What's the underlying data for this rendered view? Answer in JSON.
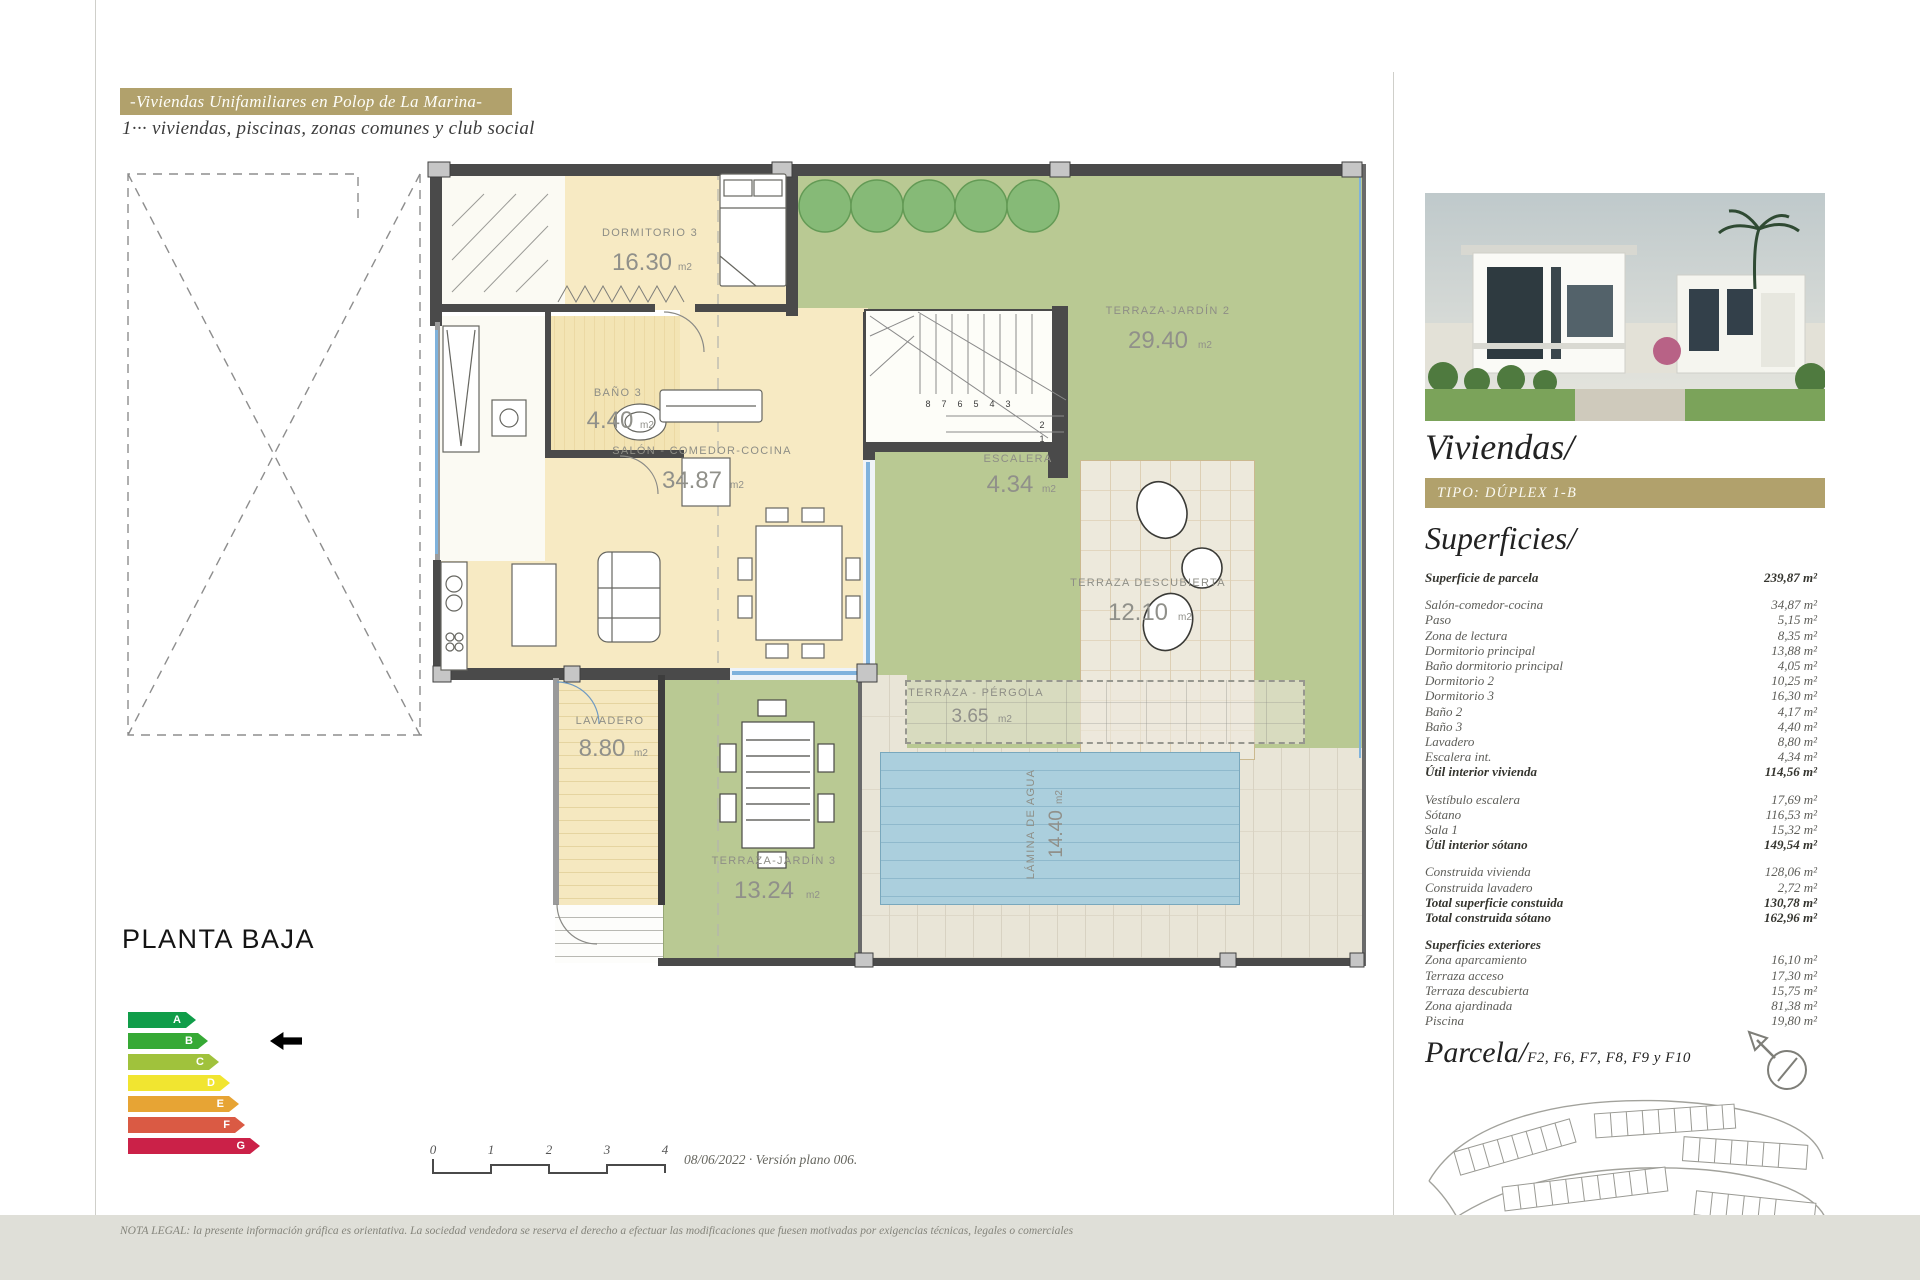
{
  "header": {
    "banner_title": "-Viviendas Unifamiliares en Polop de La Marina-",
    "subtitle": "1··· viviendas, piscinas, zonas comunes y club social",
    "accent_color": "#b1a16c"
  },
  "plan": {
    "title": "PLANTA BAJA",
    "unit": "m2",
    "rooms": {
      "dormitorio3": {
        "name": "DORMITORIO 3",
        "area": "16.30"
      },
      "bano3": {
        "name": "BAÑO 3",
        "area": "4.40"
      },
      "salon": {
        "name": "SALÓN - COMEDOR-COCINA",
        "area": "34.87"
      },
      "escalera": {
        "name": "ESCALERA",
        "area": "4.34"
      },
      "terraza_jardin2": {
        "name": "TERRAZA-JARDÍN 2",
        "area": "29.40"
      },
      "terraza_descubierta": {
        "name": "TERRAZA DESCUBIERTA",
        "area": "12.10"
      },
      "terraza_pergola": {
        "name": "TERRAZA - PÉRGOLA",
        "area": "3.65"
      },
      "lavadero": {
        "name": "LAVADERO",
        "area": "8.80"
      },
      "terraza_jardin3": {
        "name": "TERRAZA-JARDÍN 3",
        "area": "13.24"
      },
      "lamina_agua": {
        "name": "LÁMINA DE AGUA",
        "area": "14.40"
      }
    },
    "stairs": [
      "8",
      "7",
      "6",
      "5",
      "4",
      "3",
      "2",
      "1"
    ]
  },
  "energy_chart": {
    "type": "energy-rating-scale",
    "items": [
      {
        "letter": "A",
        "color": "#109d49"
      },
      {
        "letter": "B",
        "color": "#36a935"
      },
      {
        "letter": "C",
        "color": "#a0c23c"
      },
      {
        "letter": "D",
        "color": "#f1e530"
      },
      {
        "letter": "E",
        "color": "#e7a434"
      },
      {
        "letter": "F",
        "color": "#da5a44"
      },
      {
        "letter": "G",
        "color": "#cb2148"
      }
    ],
    "marker": "B"
  },
  "scale_bar": {
    "ticks": [
      "0",
      "1",
      "2",
      "3",
      "4"
    ],
    "note": "08/06/2022 · Versión plano 006."
  },
  "sidebar": {
    "title": "Viviendas/",
    "tipo_banner": "TIPO: DÚPLEX 1-B",
    "superficies_title": "Superficies/",
    "parcela_title": "Parcela/",
    "parcela_refs": "F2, F6, F7, F8, F9 y F10",
    "accent_color": "#b1a16c",
    "plot_highlight_color": "#d4156b",
    "table": {
      "sections": [
        {
          "rows": [
            {
              "label": "Superficie de parcela",
              "value": "239,87 m²",
              "bold": true
            }
          ]
        },
        {
          "rows": [
            {
              "label": "Salón-comedor-cocina",
              "value": "34,87 m²"
            },
            {
              "label": "Paso",
              "value": "5,15 m²"
            },
            {
              "label": "Zona de lectura",
              "value": "8,35 m²"
            },
            {
              "label": "Dormitorio principal",
              "value": "13,88 m²"
            },
            {
              "label": "Baño dormitorio principal",
              "value": "4,05 m²"
            },
            {
              "label": "Dormitorio 2",
              "value": "10,25 m²"
            },
            {
              "label": "Dormitorio 3",
              "value": "16,30 m²"
            },
            {
              "label": "Baño 2",
              "value": "4,17 m²"
            },
            {
              "label": "Baño 3",
              "value": "4,40 m²"
            },
            {
              "label": "Lavadero",
              "value": "8,80 m²"
            },
            {
              "label": "Escalera int.",
              "value": "4,34 m²"
            },
            {
              "label": "Útil interior vivienda",
              "value": "114,56 m²",
              "bold": true
            }
          ]
        },
        {
          "rows": [
            {
              "label": "Vestíbulo escalera",
              "value": "17,69 m²"
            },
            {
              "label": "Sótano",
              "value": "116,53 m²"
            },
            {
              "label": "Sala 1",
              "value": "15,32 m²"
            },
            {
              "label": "Útil interior sótano",
              "value": "149,54 m²",
              "bold": true
            }
          ]
        },
        {
          "rows": [
            {
              "label": "Construida vivienda",
              "value": "128,06 m²"
            },
            {
              "label": "Construida lavadero",
              "value": "2,72 m²"
            },
            {
              "label": "Total superficie constuida",
              "value": "130,78 m²",
              "bold": true
            },
            {
              "label": "Total construida sótano",
              "value": "162,96 m²",
              "bold": true
            }
          ]
        },
        {
          "rows": [
            {
              "label": "Superficies exteriores",
              "value": "",
              "bold": true
            },
            {
              "label": "Zona aparcamiento",
              "value": "16,10 m²"
            },
            {
              "label": "Terraza acceso",
              "value": "17,30 m²"
            },
            {
              "label": "Terraza descubierta",
              "value": "15,75 m²"
            },
            {
              "label": "Zona ajardinada",
              "value": "81,38 m²"
            },
            {
              "label": "Piscina",
              "value": "19,80 m²"
            }
          ]
        }
      ]
    }
  },
  "legal_note": "NOTA LEGAL: la presente información gráfica es orientativa. La sociedad vendedora se reserva el derecho a efectuar las modificaciones que fuesen motivadas por exigencias técnicas, legales o comerciales"
}
